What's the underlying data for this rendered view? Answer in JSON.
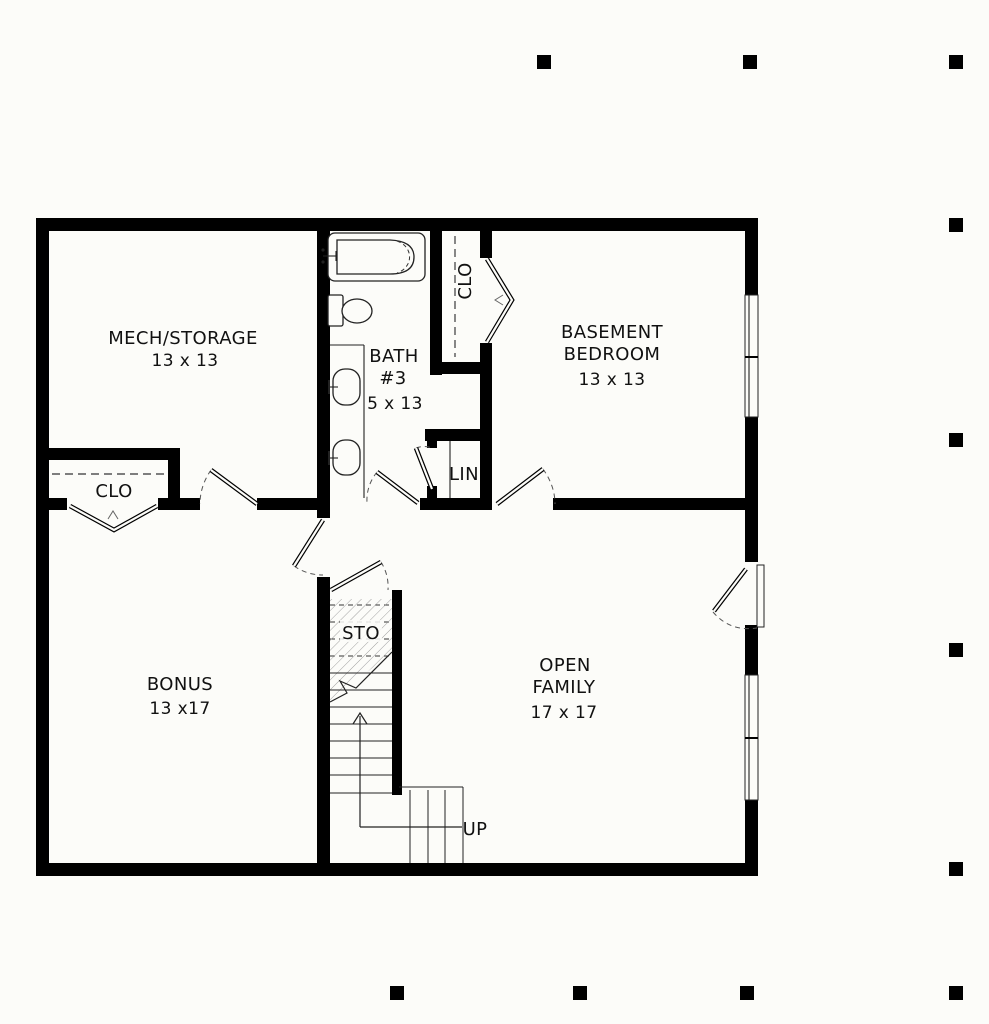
{
  "drawing": {
    "background": "#fcfcf9",
    "ink": "#000000",
    "rooms": {
      "mech_storage": {
        "name": "MECH/STORAGE",
        "dims": "13 x 13"
      },
      "bath": {
        "line1": "BATH",
        "line2": "#3",
        "dims": "5 x 13"
      },
      "basement_bedroom": {
        "line1": "BASEMENT",
        "line2": "BEDROOM",
        "dims": "13 x 13"
      },
      "bonus": {
        "name": "BONUS",
        "dims": "13 x17"
      },
      "open_family": {
        "line1": "OPEN",
        "line2": "FAMILY",
        "dims": "17 x 17"
      },
      "closet_left": {
        "name": "CLO"
      },
      "closet_bedroom": {
        "name": "CLO"
      },
      "linen": {
        "name": "LIN"
      },
      "under_stair_storage": {
        "name": "STO"
      },
      "stair": {
        "label": "UP"
      }
    }
  }
}
